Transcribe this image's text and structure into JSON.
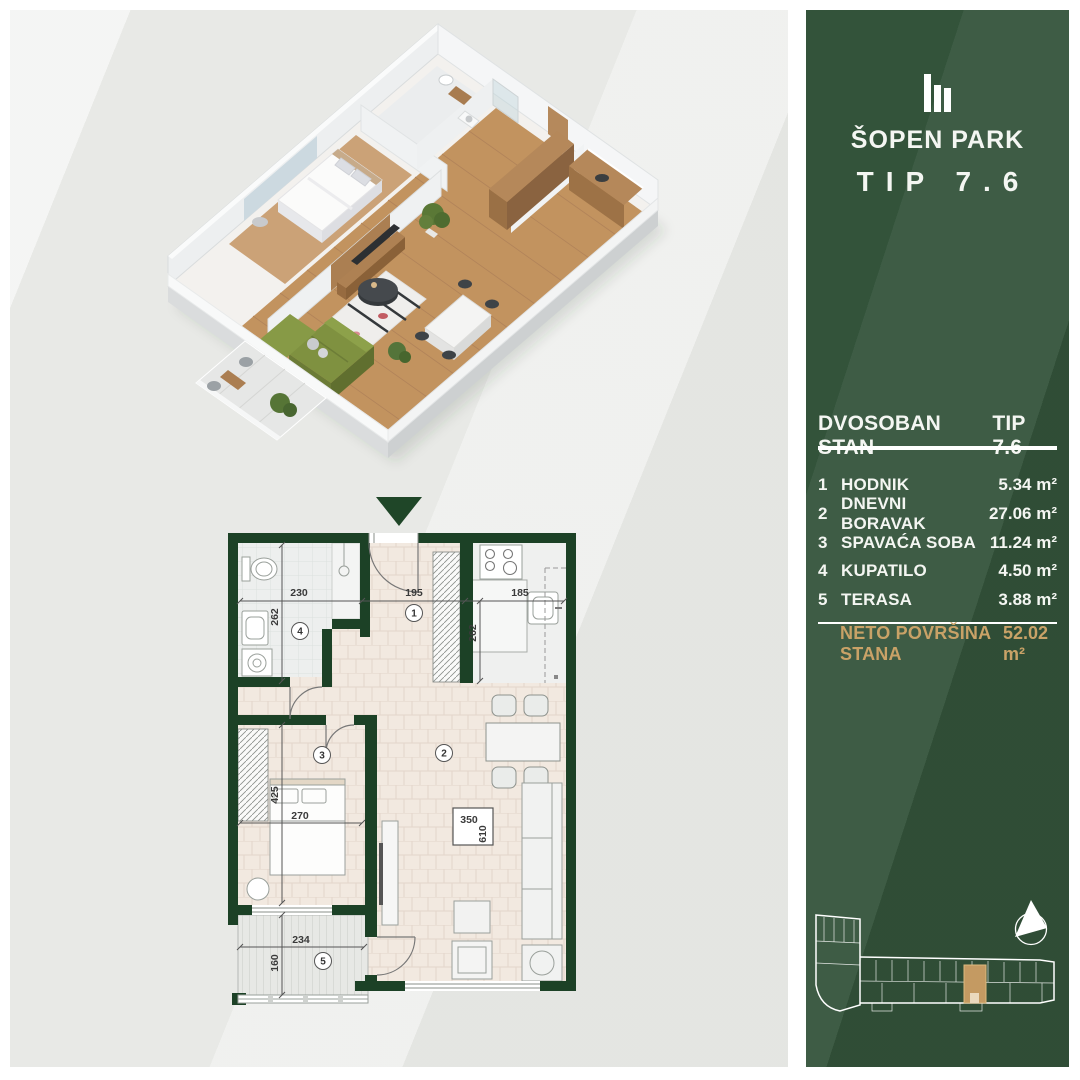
{
  "brand": {
    "logo_icon": "bar-chart-logo",
    "name": "ŠOPEN PARK",
    "type": "TIP 7.6"
  },
  "panel": {
    "header": {
      "title": "DVOSOBAN STAN",
      "type": "TIP 7.6"
    },
    "rooms": [
      {
        "num": "1",
        "name": "HODNIK",
        "area": "5.34 m²"
      },
      {
        "num": "2",
        "name": "DNEVNI BORAVAK",
        "area": "27.06 m²"
      },
      {
        "num": "3",
        "name": "SPAVAĆA SOBA",
        "area": "11.24 m²"
      },
      {
        "num": "4",
        "name": "KUPATILO",
        "area": "4.50 m²"
      },
      {
        "num": "5",
        "name": "TERASA",
        "area": "3.88 m²"
      }
    ],
    "total": {
      "label": "NETO POVRŠINA STANA",
      "value": "52.02 m²"
    }
  },
  "floorplan": {
    "rooms": {
      "hall": "1",
      "living": "2",
      "bedroom": "3",
      "bathroom": "4",
      "terrace": "5"
    },
    "dims": {
      "bath_w": "230",
      "bath_h": "262",
      "hall_w": "195",
      "kitchen_w": "185",
      "kitchen_h": "262",
      "bedroom_w": "270",
      "bedroom_h": "425",
      "terrace_w": "234",
      "terrace_h": "160",
      "tv_w": "350",
      "tv_h": "610"
    }
  },
  "icons": {
    "down_arrow": "triangle-down",
    "compass": "north-arrow"
  },
  "colors": {
    "panel_green": "#33533a",
    "wall_green": "#1c4126",
    "accent_gold": "#c9a267"
  }
}
